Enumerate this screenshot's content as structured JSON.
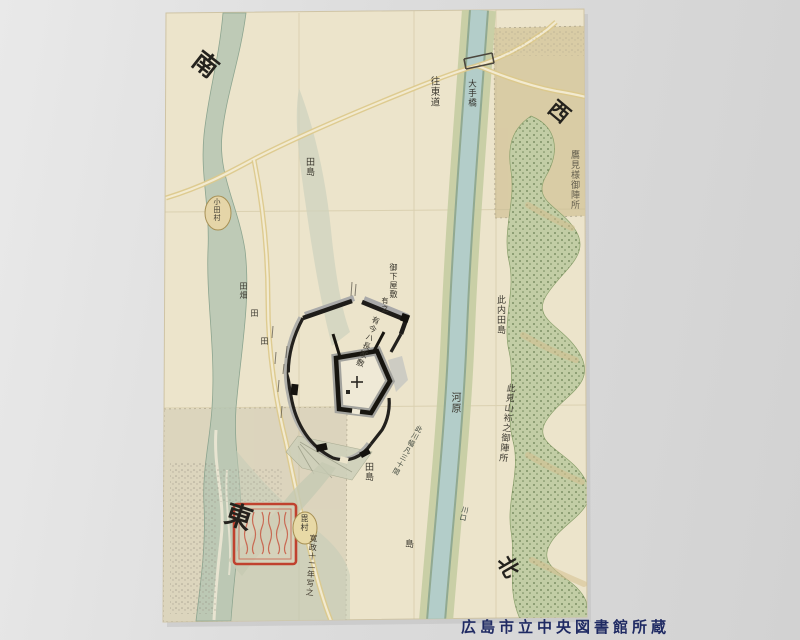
{
  "photo": {
    "credit": "広島市立中央図書館所蔵"
  },
  "colors": {
    "paper": "#ece4cb",
    "river_water": "#b3cdc9",
    "river_bank": "#c7cea3",
    "hills_green": "#c2cda5",
    "road_tan": "#dcc98b",
    "seal_red": "#c03a27",
    "credit_navy": "#1f2a63"
  },
  "map": {
    "corners": {
      "south": "南",
      "west": "西",
      "east": "東",
      "north": "北"
    },
    "labels": {
      "road_name": "往東道",
      "bridge": "大手橋",
      "field_island_top": "田島",
      "field_patch": "田畑",
      "field_1": "田",
      "field_2": "田",
      "shimo_yashiki": "御下屋敷",
      "shimo_yashiki_note": "有之",
      "nagaya_note": "有今ハ長家敷",
      "kono_uchi_tajima": "此内田島",
      "hill_camp": "此見山袮之御陣所",
      "takami_camp": "鷹見様御陣所",
      "kawara": "河原",
      "tajima_bottom": "田島",
      "shima": "島",
      "river_width_note": "此川幅凡三十間",
      "river_mark": "川口",
      "village_oval_top": "小田村",
      "village_oval_bottom": "毘村",
      "seal_inscription": "寛政十二年写之"
    }
  }
}
